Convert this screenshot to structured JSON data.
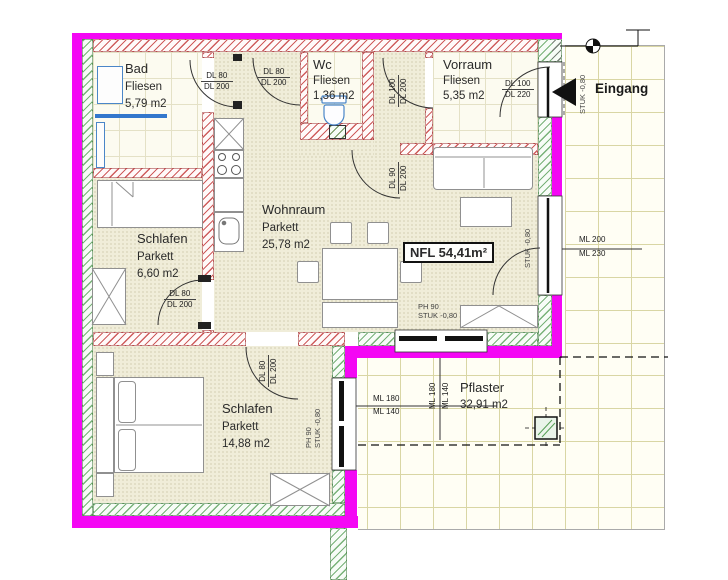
{
  "rooms": {
    "bad": {
      "name": "Bad",
      "finish": "Fliesen",
      "area": "5,79 m2"
    },
    "wc": {
      "name": "Wc",
      "finish": "Fliesen",
      "area": "1,36 m2"
    },
    "vorraum": {
      "name": "Vorraum",
      "finish": "Fliesen",
      "area": "5,35 m2"
    },
    "wohnraum": {
      "name": "Wohnraum",
      "finish": "Parkett",
      "area": "25,78 m2"
    },
    "schlafen_klein": {
      "name": "Schlafen",
      "finish": "Parkett",
      "area": "6,60 m2"
    },
    "schlafen_gross": {
      "name": "Schlafen",
      "finish": "Parkett",
      "area": "14,88 m2"
    },
    "pflaster": {
      "name": "Pflaster",
      "area": "32,91 m2"
    }
  },
  "labels": {
    "nfl_total": "NFL 54,41m²",
    "eingang": "Eingang",
    "stuk_entrance": "STUK -0,80",
    "stuk_terrace_door": "STUK -0,80",
    "ph_wohnraum": "PH 90",
    "stuk_wohnraum": "STUK -0,80",
    "ph_schlafen": "PH 90",
    "stuk_schlafen": "STUK -0,80"
  },
  "doors": {
    "bad": {
      "width": "DL 80",
      "height": "DL 200"
    },
    "wc": {
      "width": "DL 80",
      "height": "DL 200"
    },
    "vorraum": {
      "width": "DL 100",
      "height": "DL 200"
    },
    "wohnraum": {
      "width": "DL 90",
      "height": "DL 200"
    },
    "eingang": {
      "width": "DL 100",
      "height": "DL 220"
    },
    "schlafen_klein": {
      "width": "DL 80",
      "height": "DL 200"
    },
    "schlafen_gross": {
      "width": "DL 80",
      "height": "DL 200"
    }
  },
  "windows": {
    "terrace_door": {
      "top": "ML 200",
      "bottom": "ML 230"
    },
    "wohnraum": {
      "top": "ML 180",
      "bottom": "ML 140"
    },
    "schlafen": {
      "top": "ML 180",
      "bottom": "ML 140"
    }
  },
  "colors": {
    "outline_magenta": "#f407f4",
    "new_wall_hatch": "#c64040",
    "existing_wall_hatch": "#569e56",
    "fixture_blue": "#4a86c8"
  }
}
